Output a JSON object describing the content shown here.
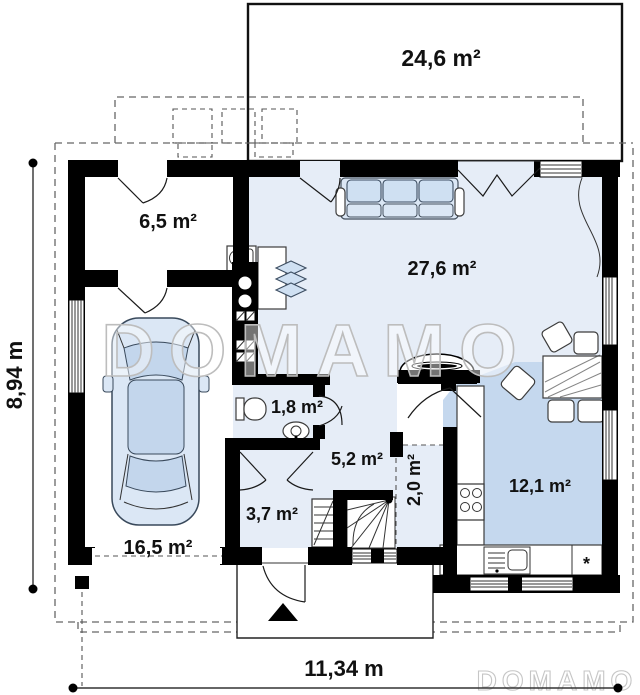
{
  "plan": {
    "title_watermark": "DOMAMO",
    "corner_watermark": "DOMAMO",
    "rooms": {
      "terrace": {
        "area": "24,6 m²"
      },
      "vestibule": {
        "area": "6,5 m²"
      },
      "living": {
        "area": "27,6 m²"
      },
      "wc": {
        "area": "1,8 m²"
      },
      "corridor": {
        "area": "5,2 m²"
      },
      "pantry": {
        "area": "2,0 m²"
      },
      "kitchen": {
        "area": "12,1 m²"
      },
      "hall": {
        "area": "3,7 m²"
      },
      "garage": {
        "area": "16,5 m²"
      }
    },
    "dimensions": {
      "overall_width": "11,34 m",
      "overall_height": "8,94 m"
    },
    "symbols": {
      "kitchen_appliance_star": "*"
    },
    "colors": {
      "wall": "#000000",
      "floor_light_blue": "#e6edf7",
      "floor_medium_blue": "#c5d8ee",
      "furniture_blue": "#cfe0f2",
      "watermark_gray": "#bdbdbd",
      "dashed_outline_gray": "#666666"
    }
  }
}
